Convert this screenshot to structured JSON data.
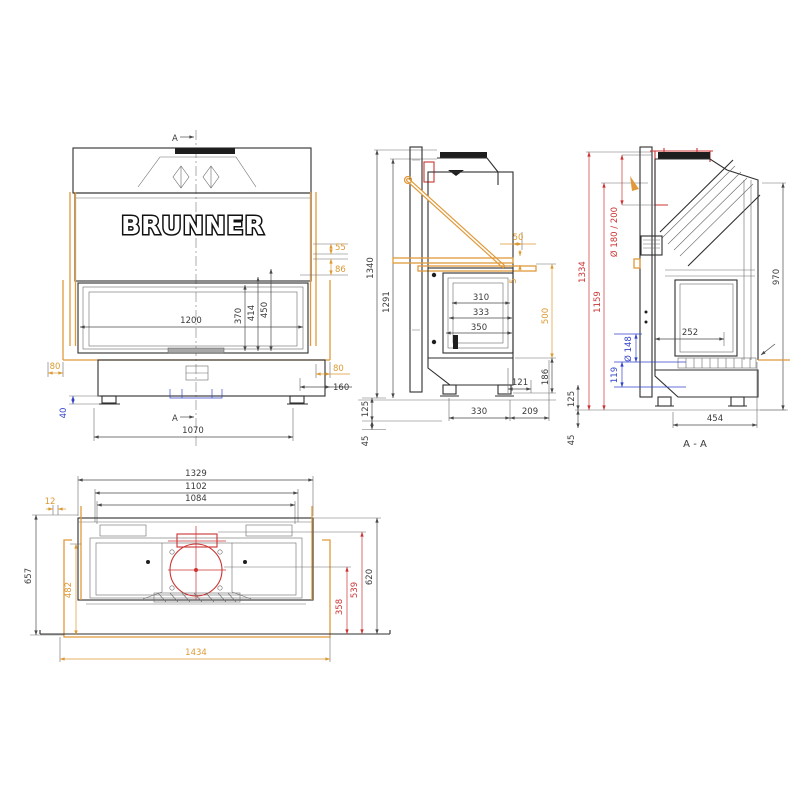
{
  "brand": "BRUNNER",
  "colors": {
    "accent_orange": "#DD9933",
    "accent_red": "#CC3333",
    "accent_blue": "#3344CC",
    "line": "#2f2f2f"
  },
  "views": {
    "front": {
      "marker_top": "A",
      "marker_bottom": "A",
      "dims": {
        "w1200": "1200",
        "h370": "370",
        "h414": "414",
        "h450": "450",
        "o55": "55",
        "o86": "86",
        "o80r": "80",
        "b160": "160",
        "o80l": "80",
        "b40": "40",
        "w1070": "1070"
      }
    },
    "side": {
      "dims": {
        "h1340": "1340",
        "h1291": "1291",
        "o50": "50",
        "o5": "5",
        "o500": "500",
        "g310": "310",
        "g333": "333",
        "g350": "350",
        "b121": "121",
        "h186": "186",
        "w330": "330",
        "w209": "209",
        "p125": "125",
        "f45": "45"
      }
    },
    "section": {
      "label": "A - A",
      "dims": {
        "h1334": "1334",
        "h1159": "1159",
        "h970": "970",
        "flue": "Ø 180 / 200",
        "d252": "252",
        "air": "Ø 148",
        "h119": "119",
        "d454": "454",
        "p125": "125",
        "f45": "45"
      }
    },
    "plan": {
      "dims": {
        "w1329": "1329",
        "w1102": "1102",
        "w1084": "1084",
        "o12": "12",
        "d657": "657",
        "d482": "482",
        "d620": "620",
        "d539": "539",
        "d358": "358",
        "w1434": "1434"
      }
    }
  }
}
